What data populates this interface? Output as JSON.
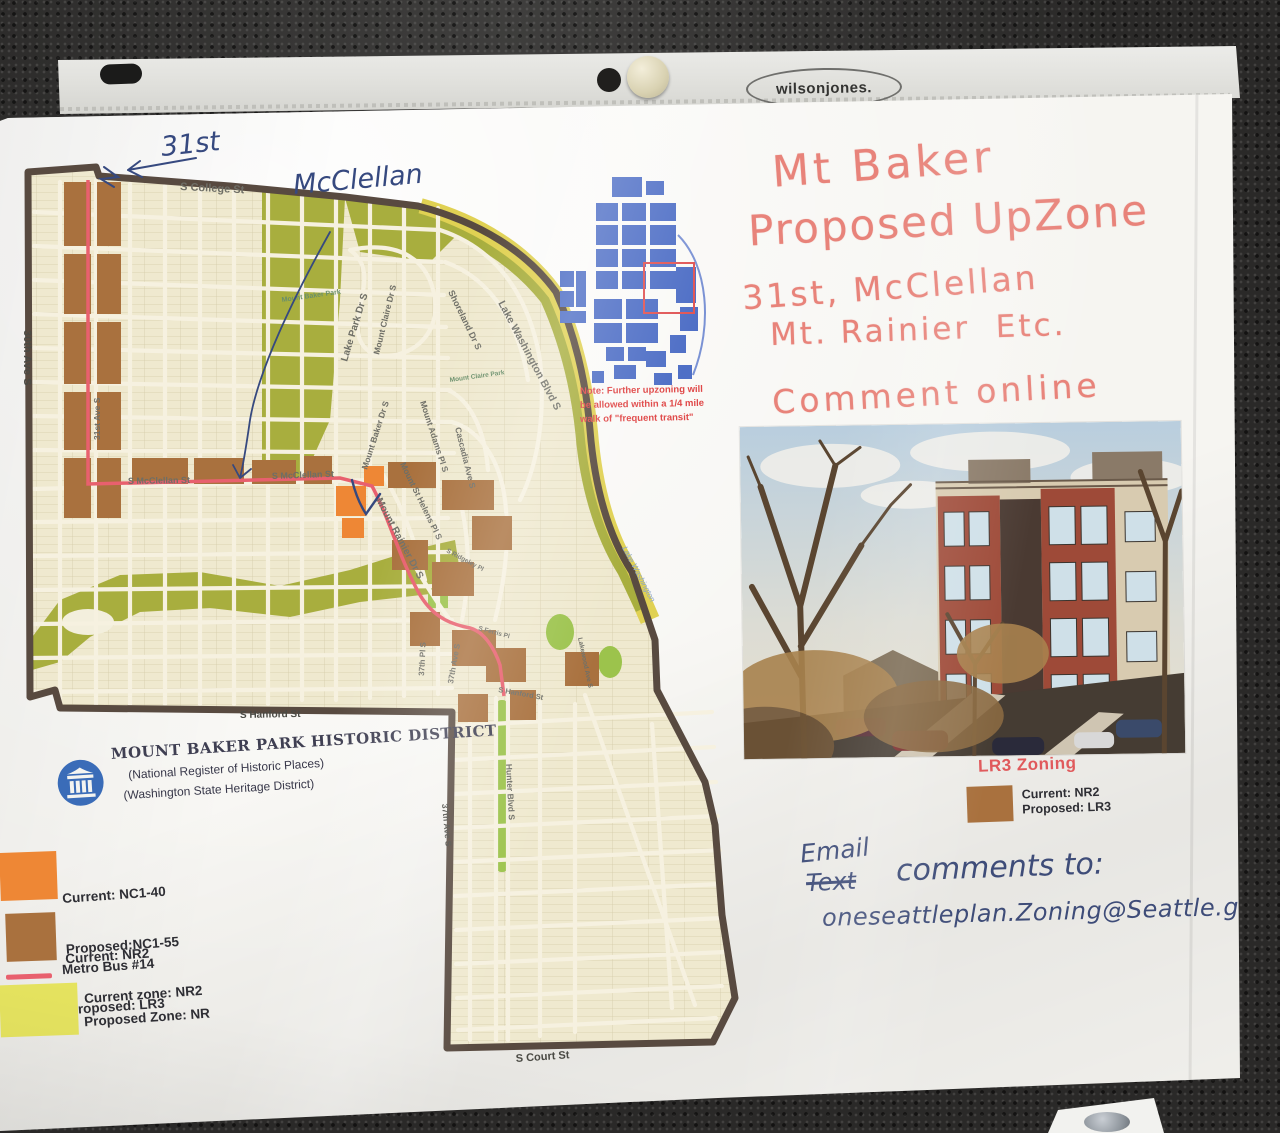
{
  "colors": {
    "background": "#2a2928",
    "paper": "#f6f5f1",
    "marker_red": "#e8837a",
    "pen_blue": "#3e4c78",
    "map_cream": "#efe9cf",
    "park_olive": "#a8ae3e",
    "park_green": "#9cc34c",
    "blvd_yellow": "#e0d153",
    "zone_orange": "#ee8735",
    "zone_brown": "#a9713e",
    "bus_red": "#e8606e",
    "boundary_brown": "#584a40",
    "inset_blue": "#4f6fc6",
    "note_red": "#e04848",
    "lr3_red": "#e05a5c",
    "legend_text": "#2e2e34"
  },
  "sleeve": {
    "brand": "wilsonjones."
  },
  "headline": {
    "line1": "Mt Baker",
    "line2": "Proposed UpZone",
    "line3": "31st, McClellan",
    "line4": "Mt. Rainier  Etc.",
    "line5": "Comment online"
  },
  "pen_notes": {
    "thirty_first": "31st",
    "mcclellan": "McClellan"
  },
  "email_note": {
    "email_word": "Email",
    "struck_word": "Text",
    "comments_to": "comments to:",
    "address": "oneseattleplan.Zoning@Seattle.gov"
  },
  "inset": {
    "note_line1": "Note:  Further upzoning will",
    "note_line2": "be allowed within a 1/4 mile",
    "note_line3": "walk of \"frequent transit\""
  },
  "historic": {
    "title": "MOUNT BAKER PARK HISTORIC DISTRICT",
    "subtitle1": "(National Register of Historic Places)",
    "subtitle2": "(Washington State Heritage District)"
  },
  "legend": {
    "items": [
      {
        "swatch": "orange",
        "line1": "Current: NC1-40",
        "line2": "Proposed:NC1-55"
      },
      {
        "swatch": "brown",
        "line1": "Current: NR2",
        "line2": "Proposed: LR3"
      },
      {
        "swatch": "red-line",
        "line1": "Metro Bus #14",
        "line2": ""
      },
      {
        "swatch": "yellow",
        "line1": "Current zone: NR2",
        "line2": "Proposed Zone: NR"
      }
    ]
  },
  "lr3": {
    "heading": "LR3 Zoning",
    "line1": "Current: NR2",
    "line2": "Proposed: LR3"
  },
  "map_labels": {
    "college": "S College St",
    "ave30": "30th Ave S",
    "ave31": "31st Ave S",
    "mcclellan1": "S McClellan St",
    "mcclellan2": "S McClellan St",
    "mt_baker_park": "Mount Baker Park",
    "lake_park": "Lake Park Dr S",
    "mount_claire_dr": "Mount Claire Dr S",
    "mount_baker_dr": "Mount Baker Dr S",
    "shoreland": "Shoreland Dr S",
    "mount_claire_park": "Mount Claire Park",
    "mount_adams": "Mount Adams Pl S",
    "cascadia": "Cascadia Ave S",
    "lake_wash_blvd": "Lake Washington Blvd S",
    "mount_st_helens": "Mount St Helens Pl S",
    "mount_rainier": "Mount Rainier Dr S",
    "ridgeley": "S Ridgeley Pl",
    "pl37": "37th Pl S",
    "ave37a": "37th Ave S",
    "ferris": "S Ferris Pl",
    "lakewood": "Lakewood Ave S",
    "hanford1": "S Hanford St",
    "hanford2": "S Hanford St",
    "hunter": "Hunter Blvd S",
    "ave37b": "37th Ave S",
    "court": "S Court St",
    "lake_washington": "Lake Washington"
  }
}
